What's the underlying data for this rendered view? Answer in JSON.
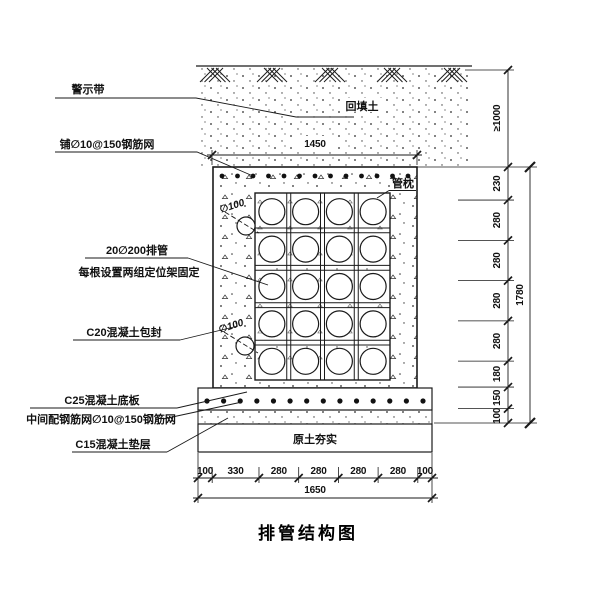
{
  "title": "排管结构图",
  "annotations": {
    "warning_tape": "警示带",
    "top_rebar_mesh": "铺∅10@150钢筋网",
    "pipe_row_line1": "20∅200排管",
    "pipe_row_line2": "每根设置两组定位架固定",
    "concrete_encasement": "C20混凝土包封",
    "concrete_base_plate": "C25混凝土底板",
    "middle_rebar_mesh": "中间配钢筋网∅10@150钢筋网",
    "concrete_cushion": "C15混凝土垫层",
    "backfill_soil": "回填土",
    "pipe_pillow": "管枕",
    "compacted_soil": "原土夯实",
    "drain_pipe_label": "∅100"
  },
  "dimensions": {
    "top_width": "1450",
    "cover_depth": "≥1000",
    "right_segments": [
      "230",
      "280",
      "280",
      "280",
      "280",
      "180",
      "150",
      "100"
    ],
    "right_total": "1780",
    "bottom_segments": [
      "100",
      "330",
      "280",
      "280",
      "280",
      "280",
      "100"
    ],
    "bottom_total": "1650"
  },
  "pipe_grid": {
    "rows": 5,
    "cols": 4
  },
  "colors": {
    "line": "#1a1a1a",
    "text": "#111111",
    "background": "#ffffff"
  }
}
